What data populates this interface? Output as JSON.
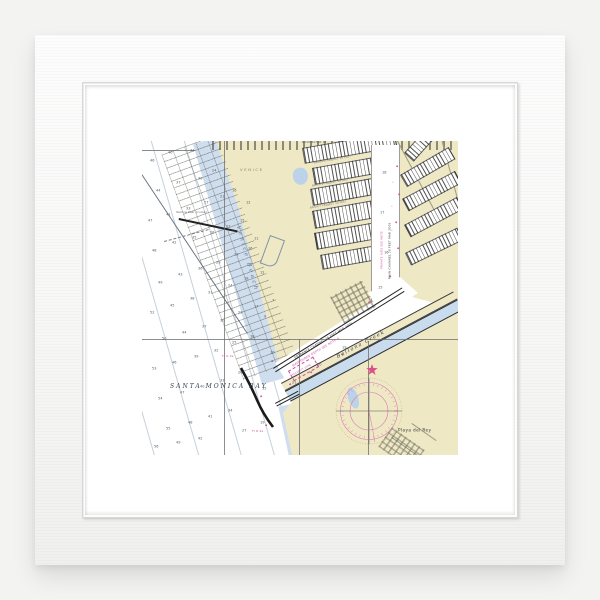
{
  "scene": {
    "background": "#f3f3f2",
    "frame_color": "#fbfbfb",
    "mat_color": "#ffffff",
    "artwork_type": "framed nautical chart print"
  },
  "chart": {
    "colors": {
      "land": "#efe8c5",
      "water": "#ffffff",
      "shallow_blue": "#cfdeee",
      "creek_blue": "#c9dcee",
      "magenta": "#cf4f9e",
      "ink": "#2e2e2e",
      "star_red": "#dc4f84"
    },
    "labels": [
      {
        "id": "santa-monica-bay",
        "text": "SANTA MONICA BAY",
        "x": 28,
        "y": 242,
        "rot": 0,
        "size": 6,
        "ls": 2.0,
        "color": "#2f3e4c",
        "style": "serif-italic"
      },
      {
        "id": "venice-beach",
        "text": "Venice Beach",
        "x": 99,
        "y": 84,
        "rot": 74,
        "size": 5.5,
        "ls": 2.6,
        "color": "#5f7182",
        "style": "serif-italic"
      },
      {
        "id": "ballona-creek",
        "text": "Ballona Creek",
        "x": 194,
        "y": 214,
        "rot": -28,
        "size": 5,
        "ls": 1.4,
        "color": "#2f3e4c",
        "style": "serif-italic"
      },
      {
        "id": "playa-del-rey",
        "text": "Playa del Rey",
        "x": 256,
        "y": 287,
        "rot": 0,
        "size": 4.2,
        "ls": 0.4,
        "color": "#333333",
        "style": "sans"
      },
      {
        "id": "venice-town",
        "text": "VENICE",
        "x": 98,
        "y": 27,
        "rot": 0,
        "size": 3.8,
        "ls": 1.6,
        "color": "#85857a",
        "style": "sans"
      },
      {
        "id": "entrance-note",
        "text": "ENTRANCE CHANNEL 20 FEET MAR 2005",
        "x": 152,
        "y": 216,
        "rot": -31,
        "size": 3,
        "ls": 0.2,
        "color": "#333333",
        "style": "sans"
      },
      {
        "id": "entrance-note-2",
        "text": "MAINTAINED DEPTH SEE NOTE A",
        "x": 150,
        "y": 224,
        "rot": -31,
        "size": 3,
        "ls": 0.2,
        "color": "#cf4f9e",
        "style": "sans"
      },
      {
        "id": "main-channel-note",
        "text": "MAIN CHANNEL 20 FEET MAR 2005",
        "x": 247,
        "y": 138,
        "rot": -90,
        "size": 2.9,
        "ls": 0.2,
        "color": "#444444",
        "style": "sans"
      },
      {
        "id": "private-aids-note",
        "text": "PRIVATE AIDS SEE NOTE",
        "x": 239,
        "y": 128,
        "rot": -90,
        "size": 2.8,
        "ls": 0.2,
        "color": "#cf4f9e",
        "style": "sans"
      },
      {
        "id": "light-green",
        "text": "Fl G 4s",
        "x": 80,
        "y": 214,
        "rot": 0,
        "size": 3,
        "ls": 0.2,
        "color": "#cf4f9e",
        "style": "sans"
      },
      {
        "id": "light-red",
        "text": "Fl R 4s",
        "x": 110,
        "y": 289,
        "rot": 0,
        "size": 3,
        "ls": 0.2,
        "color": "#cf4f9e",
        "style": "sans"
      },
      {
        "id": "venice-pier",
        "text": "Venice Pier (ruins)",
        "x": 34,
        "y": 70,
        "rot": 0,
        "size": 3,
        "ls": 0.2,
        "color": "#555555",
        "style": "sans"
      },
      {
        "id": "security-zone",
        "text": "SECURITY ZONE",
        "x": 150,
        "y": 234,
        "rot": -30,
        "size": 2.4,
        "ls": 0.2,
        "color": "#cf4f9e",
        "style": "sans"
      },
      {
        "id": "basin-d",
        "text": "BASIN D PROJECT 10 FEET",
        "x": 172,
        "y": 21,
        "rot": -10,
        "size": 2.5,
        "ls": 0.2,
        "color": "#666666",
        "style": "sans"
      },
      {
        "id": "basin-e",
        "text": "BASIN E PROJECT 10 FEET",
        "x": 170,
        "y": 44,
        "rot": -10,
        "size": 2.5,
        "ls": 0.2,
        "color": "#666666",
        "style": "sans"
      },
      {
        "id": "basin-f",
        "text": "BASIN F PROJECT 10 FEET",
        "x": 168,
        "y": 66,
        "rot": -10,
        "size": 2.5,
        "ls": 0.2,
        "color": "#666666",
        "style": "sans"
      },
      {
        "id": "washington-st",
        "text": "WASHINGTON ST",
        "x": 160,
        "y": 1,
        "rot": 0,
        "size": 2.4,
        "ls": 0.3,
        "color": "#555555",
        "style": "sans"
      }
    ],
    "symbols": [
      {
        "x": 254,
        "y": 24,
        "ch": "◆",
        "color": "#cf4f9e",
        "size": 3
      },
      {
        "x": 256,
        "y": 52,
        "ch": "◆",
        "color": "#cf4f9e",
        "size": 3
      },
      {
        "x": 253,
        "y": 80,
        "ch": "◆",
        "color": "#cf4f9e",
        "size": 3
      },
      {
        "x": 255,
        "y": 106,
        "ch": "◆",
        "color": "#cf4f9e",
        "size": 3
      },
      {
        "x": 247,
        "y": 134,
        "ch": "◆",
        "color": "#cf4f9e",
        "size": 3
      },
      {
        "x": 129,
        "y": 219,
        "ch": "◆",
        "color": "#cf4f9e",
        "size": 3
      },
      {
        "x": 123,
        "y": 283,
        "ch": "◆",
        "color": "#cf4f9e",
        "size": 3
      },
      {
        "x": 147,
        "y": 242,
        "ch": "◆",
        "color": "#cf4f9e",
        "size": 3
      },
      {
        "x": 168,
        "y": 230,
        "ch": "◆",
        "color": "#cf4f9e",
        "size": 3
      },
      {
        "x": 199,
        "y": 212,
        "ch": "◆",
        "color": "#cf4f9e",
        "size": 3
      },
      {
        "x": 118,
        "y": 254,
        "ch": "◆",
        "color": "#cf4f9e",
        "size": 3
      },
      {
        "x": 226,
        "y": 160,
        "ch": "◆",
        "color": "#cf4f9e",
        "size": 3
      },
      {
        "x": 250,
        "y": 40,
        "ch": "•",
        "color": "#cf4f9e",
        "size": 3
      },
      {
        "x": 249,
        "y": 64,
        "ch": "•",
        "color": "#cf4f9e",
        "size": 3
      },
      {
        "x": 249,
        "y": 88,
        "ch": "•",
        "color": "#cf4f9e",
        "size": 3
      }
    ],
    "soundings": [
      [
        8,
        18,
        "46"
      ],
      [
        26,
        10,
        "40"
      ],
      [
        48,
        8,
        "34"
      ],
      [
        14,
        48,
        "44"
      ],
      [
        34,
        40,
        "37"
      ],
      [
        56,
        36,
        "30"
      ],
      [
        70,
        28,
        "24"
      ],
      [
        6,
        78,
        "47"
      ],
      [
        24,
        72,
        "41"
      ],
      [
        44,
        66,
        "33"
      ],
      [
        62,
        60,
        "27"
      ],
      [
        78,
        54,
        "21"
      ],
      [
        90,
        48,
        "16"
      ],
      [
        10,
        108,
        "48"
      ],
      [
        30,
        100,
        "42"
      ],
      [
        50,
        95,
        "35"
      ],
      [
        68,
        90,
        "28"
      ],
      [
        84,
        84,
        "22"
      ],
      [
        98,
        78,
        "15"
      ],
      [
        16,
        140,
        "49"
      ],
      [
        36,
        132,
        "43"
      ],
      [
        56,
        126,
        "36"
      ],
      [
        74,
        120,
        "29"
      ],
      [
        92,
        112,
        "23"
      ],
      [
        106,
        106,
        "16"
      ],
      [
        8,
        170,
        "52"
      ],
      [
        28,
        163,
        "45"
      ],
      [
        48,
        156,
        "38"
      ],
      [
        66,
        150,
        "31"
      ],
      [
        86,
        143,
        "24"
      ],
      [
        102,
        136,
        "18"
      ],
      [
        118,
        130,
        "12"
      ],
      [
        20,
        196,
        "50"
      ],
      [
        40,
        190,
        "44"
      ],
      [
        60,
        184,
        "37"
      ],
      [
        78,
        178,
        "30"
      ],
      [
        96,
        170,
        "23"
      ],
      [
        112,
        164,
        "17"
      ],
      [
        10,
        226,
        "53"
      ],
      [
        30,
        220,
        "46"
      ],
      [
        52,
        214,
        "39"
      ],
      [
        72,
        208,
        "32"
      ],
      [
        90,
        200,
        "25"
      ],
      [
        108,
        194,
        "18"
      ],
      [
        16,
        256,
        "54"
      ],
      [
        38,
        250,
        "47"
      ],
      [
        58,
        244,
        "40"
      ],
      [
        78,
        238,
        "33"
      ],
      [
        96,
        230,
        "26"
      ],
      [
        24,
        286,
        "55"
      ],
      [
        46,
        280,
        "48"
      ],
      [
        66,
        274,
        "41"
      ],
      [
        86,
        268,
        "34"
      ],
      [
        12,
        304,
        "56"
      ],
      [
        34,
        300,
        "49"
      ],
      [
        56,
        296,
        "42"
      ],
      [
        100,
        288,
        "27"
      ],
      [
        118,
        280,
        "19"
      ],
      [
        120,
        246,
        "15"
      ],
      [
        128,
        210,
        "10"
      ],
      [
        122,
        174,
        "9"
      ],
      [
        130,
        158,
        "7"
      ],
      [
        112,
        96,
        "11"
      ],
      [
        104,
        60,
        "12"
      ],
      [
        240,
        30,
        "18"
      ],
      [
        238,
        70,
        "17"
      ],
      [
        242,
        110,
        "16"
      ],
      [
        236,
        145,
        "15"
      ],
      [
        200,
        205,
        "19"
      ],
      [
        175,
        222,
        "20"
      ],
      [
        150,
        240,
        "21"
      ]
    ]
  }
}
